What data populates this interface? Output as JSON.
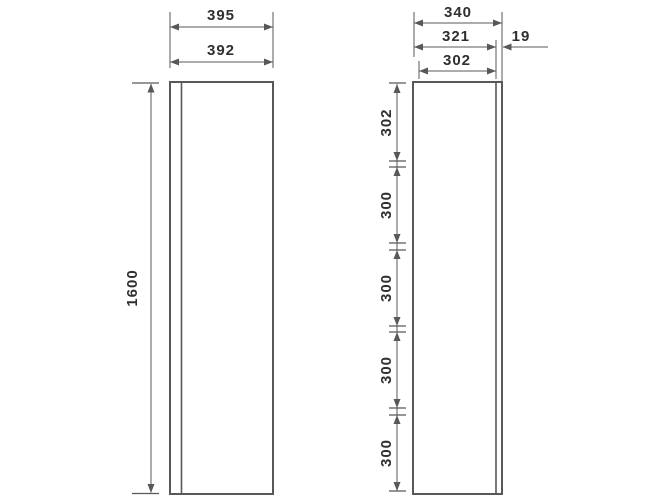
{
  "drawing": {
    "colors": {
      "background": "#ffffff",
      "stroke": "#56585b",
      "text": "#2d2f31"
    },
    "front_view": {
      "overall_width_label": "395",
      "door_width_label": "392",
      "height_label": "1600"
    },
    "side_view": {
      "overall_depth_label": "340",
      "carcass_depth_label": "321",
      "door_thickness_label": "19",
      "inner_depth_label": "302",
      "vertical_segment_labels": [
        "302",
        "300",
        "300",
        "300",
        "300"
      ]
    }
  }
}
